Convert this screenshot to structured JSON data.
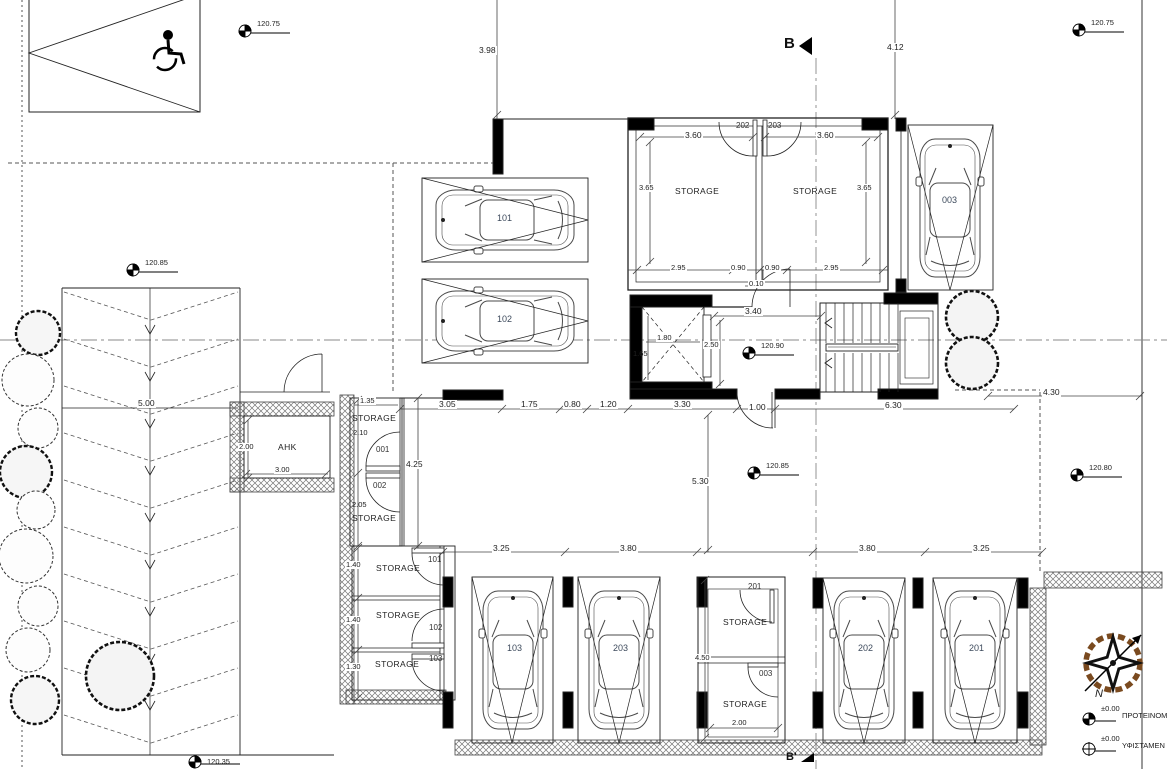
{
  "drawing": {
    "type": "basement parking floor plan"
  },
  "sections": {
    "top": "B",
    "bottom": "B'"
  },
  "elevations": {
    "top_left": "120.75",
    "top_right": "120.75",
    "left": "120.85",
    "lobby": "120.90",
    "court": "120.85",
    "right": "120.80",
    "ramp_bottom": "120.35"
  },
  "rooms": {
    "storage_202": {
      "label": "STORAGE",
      "tag": "202",
      "w": "3.60",
      "h": "3.65"
    },
    "storage_203": {
      "label": "STORAGE",
      "tag": "203",
      "w": "3.60",
      "h": "3.65"
    },
    "ahk": {
      "label": "AHK",
      "w": "3.00",
      "h": "2.00"
    },
    "st001": {
      "label": "STORAGE",
      "tag": "001",
      "w": "1.35",
      "h": "2.10"
    },
    "st002": {
      "label": "STORAGE",
      "tag": "002",
      "h": "2.05"
    },
    "st101": {
      "label": "STORAGE",
      "tag": "101",
      "h": "1.40"
    },
    "st102": {
      "label": "STORAGE",
      "tag": "102",
      "h": "1.40"
    },
    "st103": {
      "label": "STORAGE",
      "tag": "103",
      "h": "1.30"
    },
    "st201": {
      "label": "STORAGE",
      "tag": "201",
      "h": "4.50"
    },
    "st003": {
      "label": "STORAGE",
      "tag": "003",
      "w": "2.00"
    }
  },
  "parking": {
    "p101": "101",
    "p102": "102",
    "p003": "003",
    "p103": "103",
    "p203": "203",
    "p202": "202",
    "p201": "201"
  },
  "dims": {
    "d398": "3.98",
    "d412": "4.12",
    "d295a": "2.95",
    "d090a": "0.90",
    "d090b": "0.90",
    "d295b": "2.95",
    "d010": "0.10",
    "d340": "3.40",
    "d180": "1.80",
    "d165": "1.65",
    "d250": "2.50",
    "d305": "3.05",
    "d175": "1.75",
    "d080": "0.80",
    "d120": "1.20",
    "d330": "3.30",
    "d100": "1.00",
    "d630": "6.30",
    "d430": "4.30",
    "d500": "5.00",
    "d530": "5.30",
    "d425": "4.25",
    "d325a": "3.25",
    "d380a": "3.80",
    "d380b": "3.80",
    "d325b": "3.25"
  },
  "legend": {
    "proposed_level": "±0.00",
    "proposed_label": "ΠΡΟΤΕΙΝΟΜ",
    "existing_level": "±0.00",
    "existing_label": "ΥΦΙΣΤΑΜΕΝ",
    "north": "N"
  },
  "colors": {
    "line": "#1a1a1a",
    "centerline": "#888",
    "hatch": "#555",
    "compass_brown": "#7a4a1f",
    "car_label": "#3d4a5c"
  }
}
